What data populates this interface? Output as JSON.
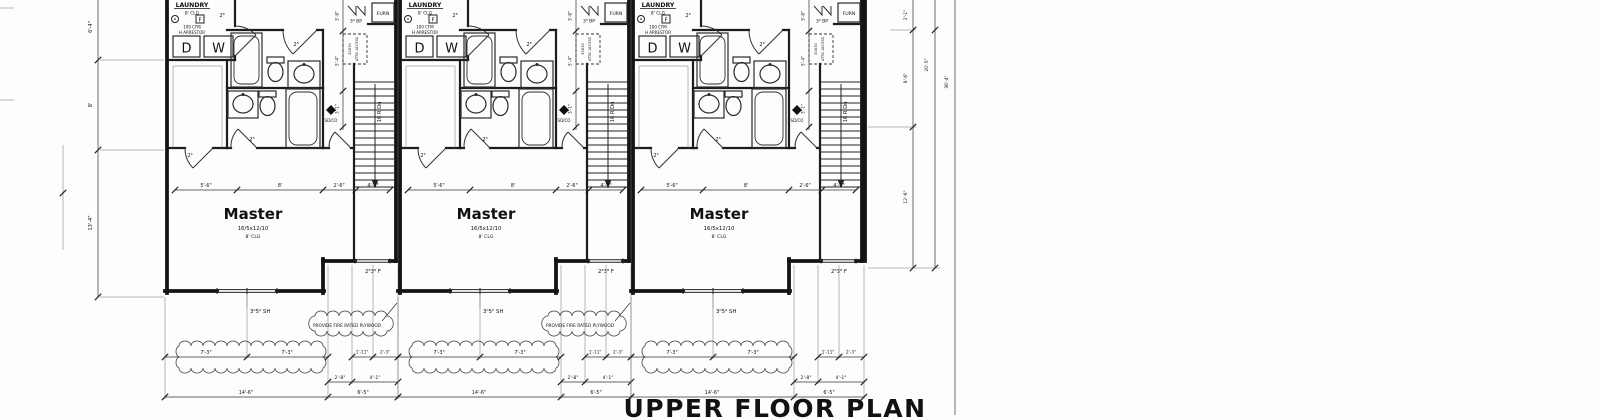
{
  "title": "UPPER FLOOR PLAN",
  "unit": {
    "laundry": {
      "name": "LAUNDRY",
      "ceiling": "8' CLG",
      "fan_tag": "F",
      "cfm": "100 CFM",
      "arrestor": "H ARRESTOR",
      "dryer": "D",
      "washer": "W"
    },
    "master": {
      "name": "Master",
      "size": "16/5x12/10",
      "ceiling": "8' CLG"
    },
    "furnace_label": "FURN",
    "stair_label": "16 R Dn",
    "smoke_co_label": "SD/CO",
    "attic_access": {
      "line1": "30X30",
      "line2": "ATTIC ACCESS"
    },
    "doors": {
      "laundry": "2⁸",
      "upper_bath": "2⁸",
      "lower_bath": "2⁶",
      "closet": "2⁴",
      "bypass": "3⁰ BP"
    },
    "windows": {
      "master": "3⁰5⁰ SH",
      "stair_bay": "2⁸3⁸ F"
    },
    "dims": {
      "room_row": [
        "5'-6\"",
        "8'",
        "2'-6\"",
        "4'-1\""
      ],
      "party_column": [
        "3'-8\"",
        "5'-4\"",
        "3'-1\""
      ],
      "bottom_row1": [
        "7'-3\"",
        "7'-3\"",
        "1'-11\"",
        "2'-3\""
      ],
      "bottom_row2": [
        "2'-8\"",
        "4'-1\""
      ],
      "bottom_row3": [
        "14'-6\"",
        "6'-5\""
      ]
    }
  },
  "notes": {
    "fire_plywood": "PROVIDE FIRE RATED PLYWOOD"
  },
  "left_dims": [
    "6'-4\"",
    "8'",
    "13'-4\""
  ],
  "right_dims": {
    "inner": [
      "2'-1\"",
      "8'-6\"",
      "12'-6\""
    ],
    "middle": "20'-5\"",
    "outer": "36'-4\""
  }
}
